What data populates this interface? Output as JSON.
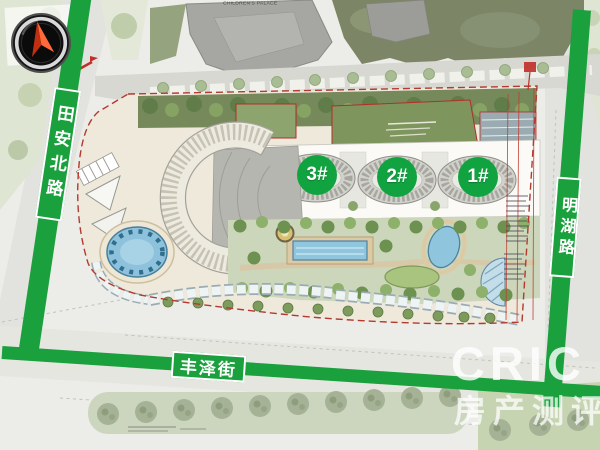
{
  "roads": {
    "left": {
      "name": "田安北路"
    },
    "right": {
      "name": "明湖路"
    },
    "bottom": {
      "name": "丰泽街"
    }
  },
  "unit_labels": [
    {
      "label": "3#"
    },
    {
      "label": "2#"
    },
    {
      "label": "1#"
    }
  ],
  "adjacent": {
    "children_palace": "CHILDREN'S PALACE"
  },
  "watermark": {
    "brand": "CRIC",
    "tagline": "房产测评"
  },
  "colors": {
    "road_band_green": "#1ba03e",
    "unit_badge_green": "#12a341",
    "boundary_red": "#b23a30",
    "pool_blue": "#8fc6de"
  }
}
